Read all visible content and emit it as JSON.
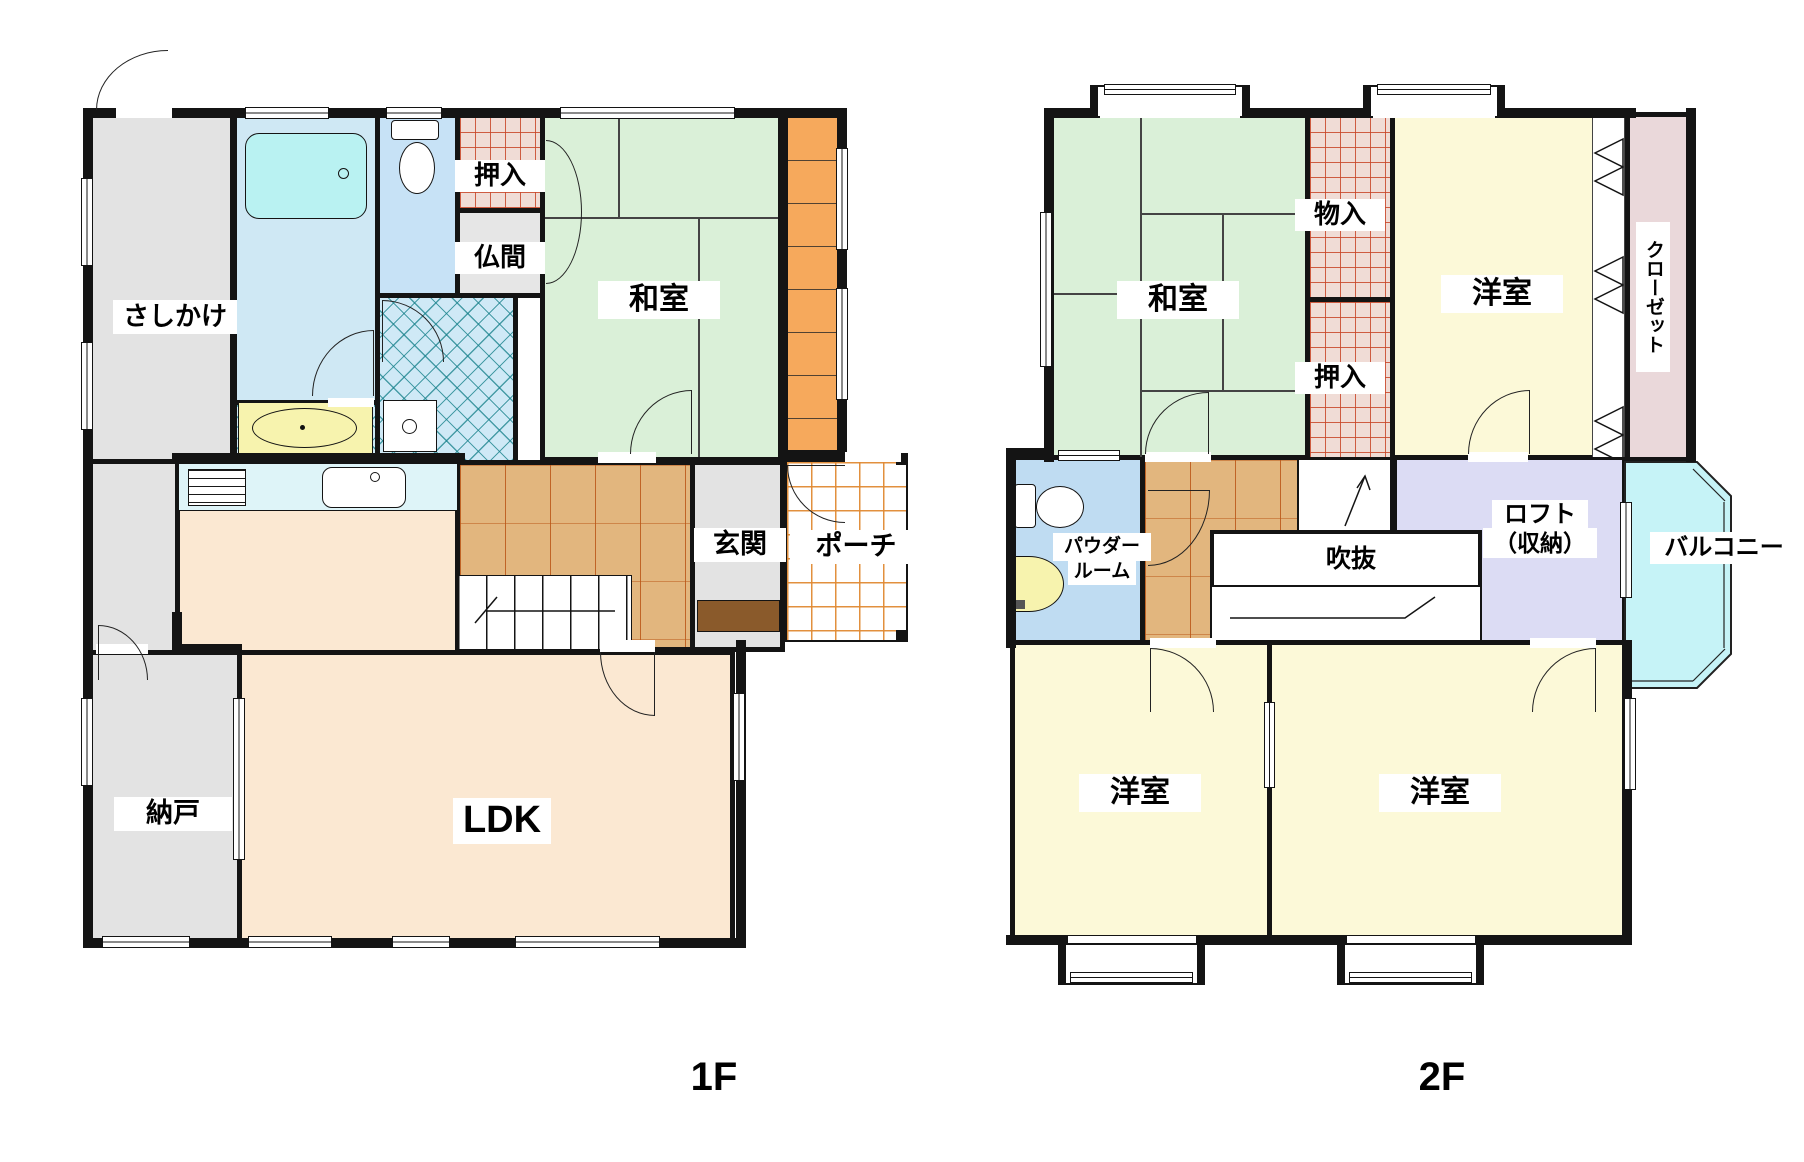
{
  "floor1": {
    "title": "1F",
    "rooms": {
      "sashikake": "さしかけ",
      "oshiire": "押入",
      "butsuma": "仏間",
      "washitsu": "和室",
      "genkan": "玄関",
      "porch": "ポーチ",
      "nando": "納戸",
      "ldk": "LDK"
    }
  },
  "floor2": {
    "title": "2F",
    "rooms": {
      "washitsu": "和室",
      "monoire": "物入",
      "oshiire": "押入",
      "yoshitsu_tr": "洋室",
      "closet": "クローゼット",
      "powder_line1": "パウダー",
      "powder_line2": "ルーム",
      "fukinuke": "吹抜",
      "loft_line1": "ロフト",
      "loft_line2": "（収納）",
      "balcony": "バルコニー",
      "yoshitsu_bl": "洋室",
      "yoshitsu_br": "洋室"
    }
  },
  "palette": {
    "wall": "#141414",
    "tatami_green": "#daf0d8",
    "wood_floor": "#e2b67e",
    "western_room_yellow": "#fcf9d8",
    "loft_lavender": "#dcdcf4",
    "balcony_cyan": "#c6f3f7",
    "closet_pink": "#ead8da",
    "storage_gray": "#e3e3e3",
    "bath_blue": "#cfe8f4",
    "ldk_cream": "#fbe8d2",
    "engawa_orange": "#f6a95c",
    "porch_grid_orange": "#e08a34",
    "hatch_teal": "#19828c",
    "closet_grid_red": "#c8463c",
    "counter_cyan": "#def4f8",
    "vanity_yellow": "#f7f3ae",
    "entry_step_brown": "#8a5a2b"
  }
}
